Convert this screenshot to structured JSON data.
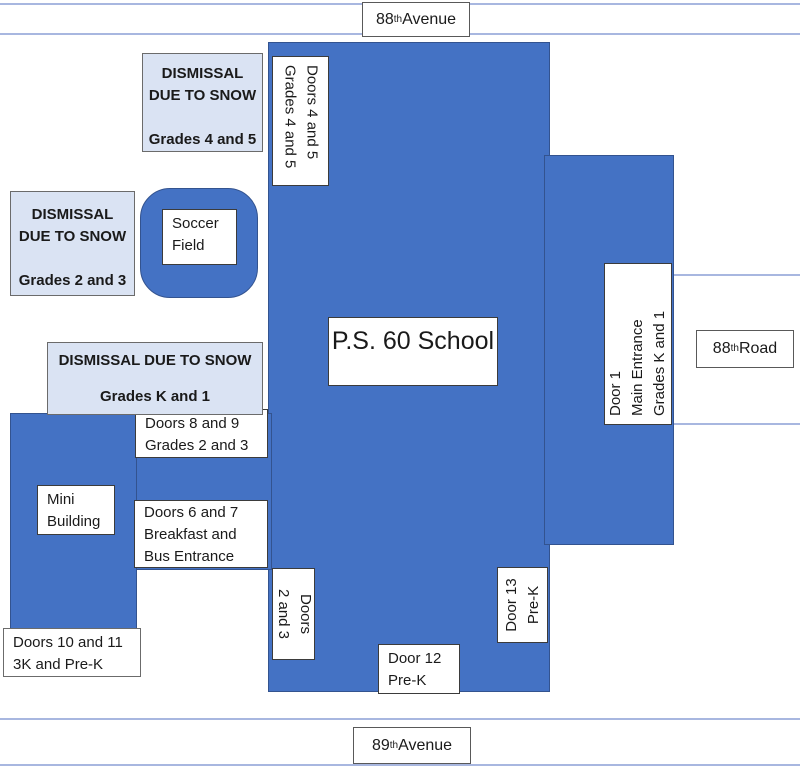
{
  "roads": {
    "avenue_top": {
      "number": "88",
      "ordinal": "th",
      "suffix": " Avenue"
    },
    "avenue_bottom": {
      "number": "89",
      "ordinal": "th",
      "suffix": " Avenue"
    },
    "road_right": {
      "number": "88",
      "ordinal": "th",
      "suffix": " Road"
    }
  },
  "school": {
    "name": "P.S. 60 School"
  },
  "areas": {
    "soccer_field": {
      "line1": "Soccer",
      "line2": "Field"
    },
    "mini_building": {
      "line1": "Mini",
      "line2": "Building"
    }
  },
  "dismissal_zones": {
    "grades_4_5": {
      "line1": "DISMISSAL",
      "line2": "DUE TO SNOW",
      "line3": "Grades 4 and 5"
    },
    "grades_2_3": {
      "line1": "DISMISSAL",
      "line2": "DUE TO SNOW",
      "line3": "Grades 2 and 3"
    },
    "grades_k_1": {
      "line1": "DISMISSAL DUE TO SNOW",
      "line2": "Grades K and 1"
    }
  },
  "doors": {
    "doors_4_5": {
      "line1": "Doors 4 and 5",
      "line2": "Grades 4 and 5"
    },
    "door_1": {
      "line1": "Door 1",
      "line2": "Main Entrance",
      "line3": "Grades K and 1"
    },
    "doors_8_9": {
      "line1": "Doors 8 and 9",
      "line2": "Grades 2 and 3"
    },
    "doors_6_7": {
      "line1": "Doors 6 and 7",
      "line2": "Breakfast and",
      "line3": "Bus Entrance"
    },
    "doors_10_11": {
      "line1": "Doors 10 and 11",
      "line2": "3K and Pre-K"
    },
    "doors_2_3": {
      "line1": "Doors",
      "line2": "2 and 3"
    },
    "door_12": {
      "line1": "Door 12",
      "line2": "Pre-K"
    },
    "door_13": {
      "line1": "Door 13",
      "line2": "Pre-K"
    }
  },
  "colors": {
    "building_fill": "#4472C4",
    "building_border": "#33538F",
    "dismissal_fill": "#DAE3F3",
    "label_border": "#3B3B3B",
    "road_line": "#A8B7E0"
  }
}
